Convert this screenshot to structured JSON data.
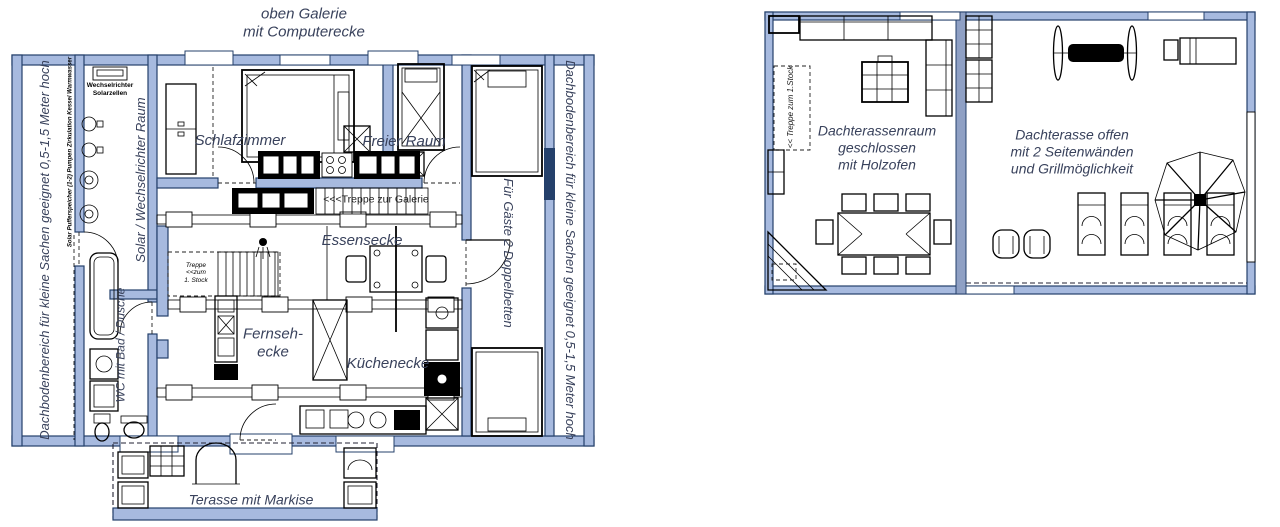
{
  "colors": {
    "wall": "#a7badf",
    "wall_stroke": "#24406b",
    "divider": "#8fa0c4",
    "label": "#39425c"
  },
  "left_plan": {
    "gallery_title": "oben Galerie\nmit Computerecke",
    "attic_left": "Dachbodenbereich  für kleine Sachen geeignet 0,5-1,5 Meter hoch",
    "attic_left_detail": "Solar Pufferspeicher (1-2) Pumpen Zirkulation Kessel Warmwasser",
    "solar_room": "Solar / Wechselrichter Raum",
    "inverter_note": "Wechselrichter\nSolarzellen",
    "bedroom": "Schlafzimmer",
    "free_room": "Freier Raum",
    "stairs_to_gallery": "<<<Treppe zur Galerie",
    "dining_corner": "Essensecke",
    "stairs_to_first_floor": "Treppe\n<<zum\n1. Stock",
    "tv_corner": "Fernseh-\necke",
    "kitchen_corner": "Küchenecke",
    "bathroom": "WC mit Bad / Dusche",
    "guest_room": "Für Gäste 2 Doppelbetten",
    "attic_right": "Dachbodenbereich  für kleine Sachen geeignet 0,5-1,5 Meter hoch",
    "terrace": "Terasse mit Markise"
  },
  "right_plan": {
    "stairs_from_first_floor": "<< Treppe zum 1.Stock",
    "closed_roof_room": "Dachterassenraum\ngeschlossen\nmit Holzofen",
    "open_roof_terrace": "Dachterasse offen\nmit 2 Seitenwänden\nund Grillmöglichkeit"
  }
}
